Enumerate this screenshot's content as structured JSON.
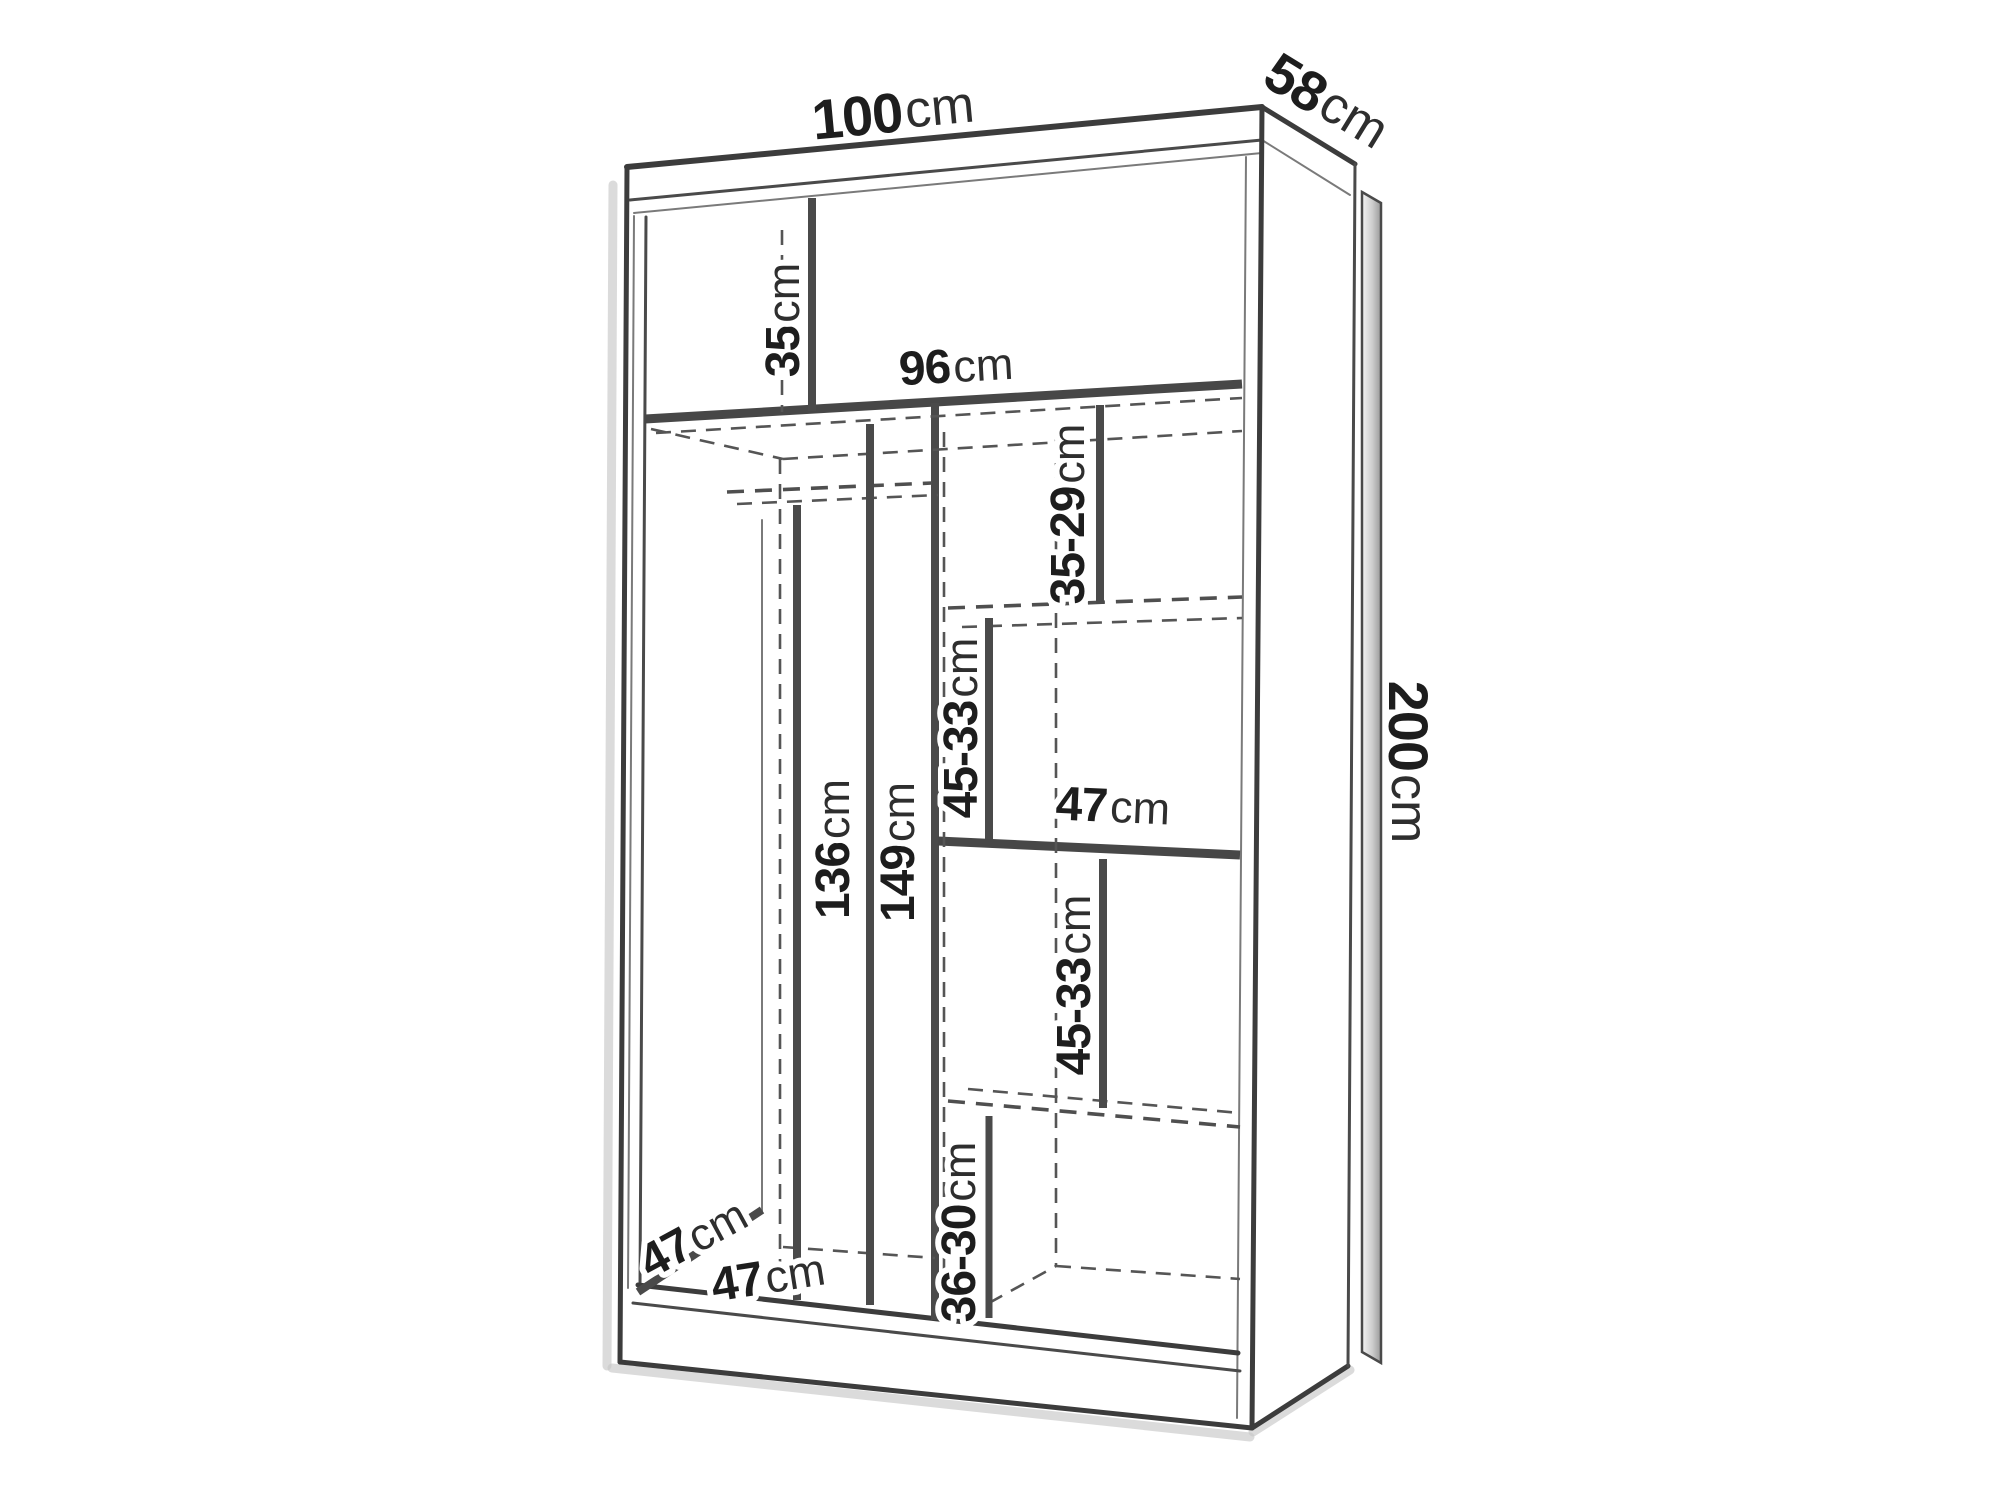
{
  "diagram": {
    "subject": "wardrobe-dimension-drawing",
    "unit": "cm"
  },
  "colors": {
    "line": "#3c3c3c",
    "text": "#1d1d1d",
    "background": "#ffffff"
  },
  "labels": {
    "width": {
      "value": "100",
      "unit": "cm"
    },
    "depth": {
      "value": "58",
      "unit": "cm"
    },
    "height": {
      "value": "200",
      "unit": "cm"
    },
    "top_section": {
      "value": "35",
      "unit": "cm"
    },
    "interior_width": {
      "value": "96",
      "unit": "cm"
    },
    "upper_right_shelf": {
      "value": "35-29",
      "unit": "cm"
    },
    "rail_height_front": {
      "value": "136",
      "unit": "cm"
    },
    "rail_height_back": {
      "value": "149",
      "unit": "cm"
    },
    "mid_right_shelf": {
      "value": "45-33",
      "unit": "cm"
    },
    "right_shelf_width": {
      "value": "47",
      "unit": "cm"
    },
    "lower_right_shelf": {
      "value": "45-33",
      "unit": "cm"
    },
    "bottom_right_shelf": {
      "value": "36-30",
      "unit": "cm"
    },
    "interior_depth": {
      "value": "47",
      "unit": "cm"
    },
    "left_section_width": {
      "value": "47",
      "unit": "cm"
    }
  }
}
